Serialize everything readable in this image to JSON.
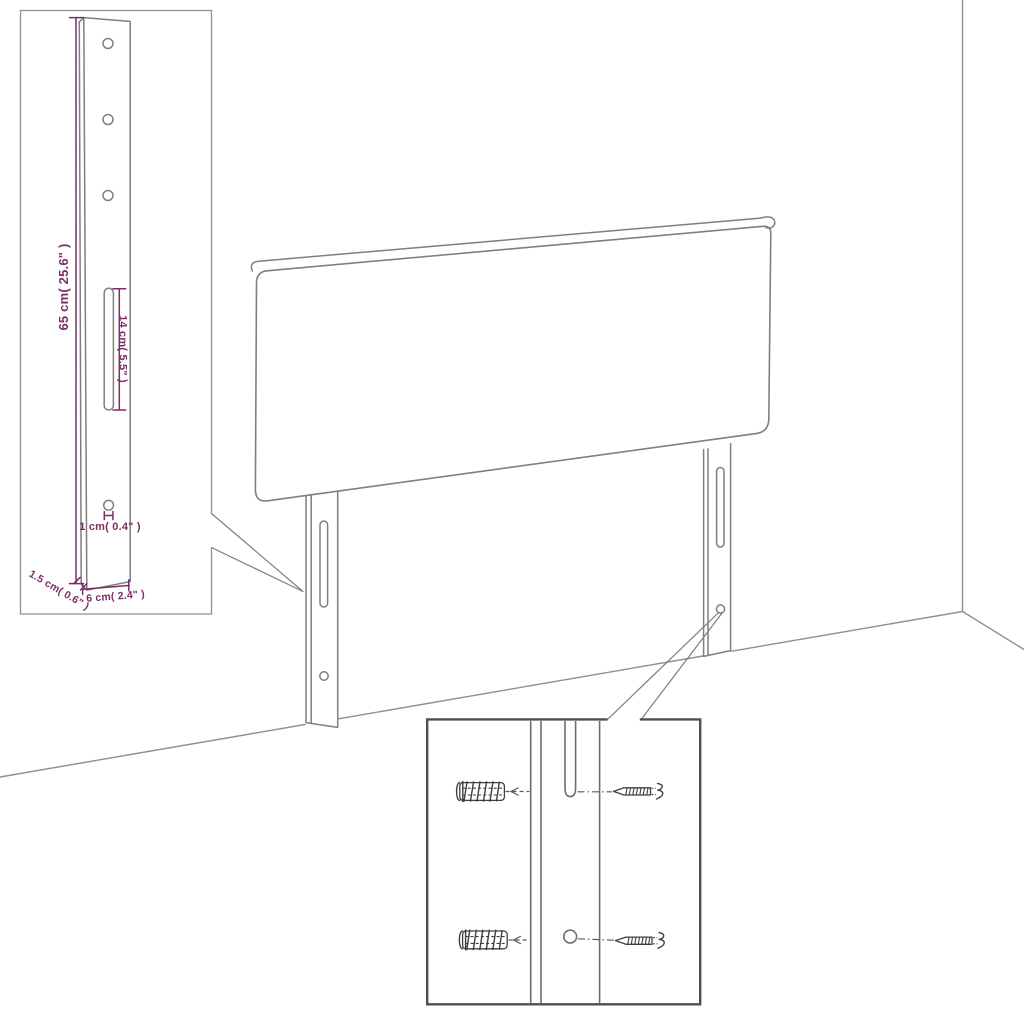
{
  "diagram": {
    "labels": {
      "bracket_height": "65 cm( 25.6\" )",
      "slot_length": "14 cm( 5.5\" )",
      "hole_diameter": "1 cm( 0.4\" )",
      "bracket_thickness": "1.5 cm( 0.6\" )",
      "bracket_width": "6 cm( 2.4\" )"
    },
    "colors": {
      "background": "#ffffff",
      "outline": "#7f7f7f",
      "outline-soft": "#8f8f8f",
      "strip": "#6e6e6e",
      "hardware": "#3f3f3f",
      "inset-border": "#4f4f4f",
      "dimension": "#7B2D66",
      "leader": "#5a5a5a"
    }
  }
}
